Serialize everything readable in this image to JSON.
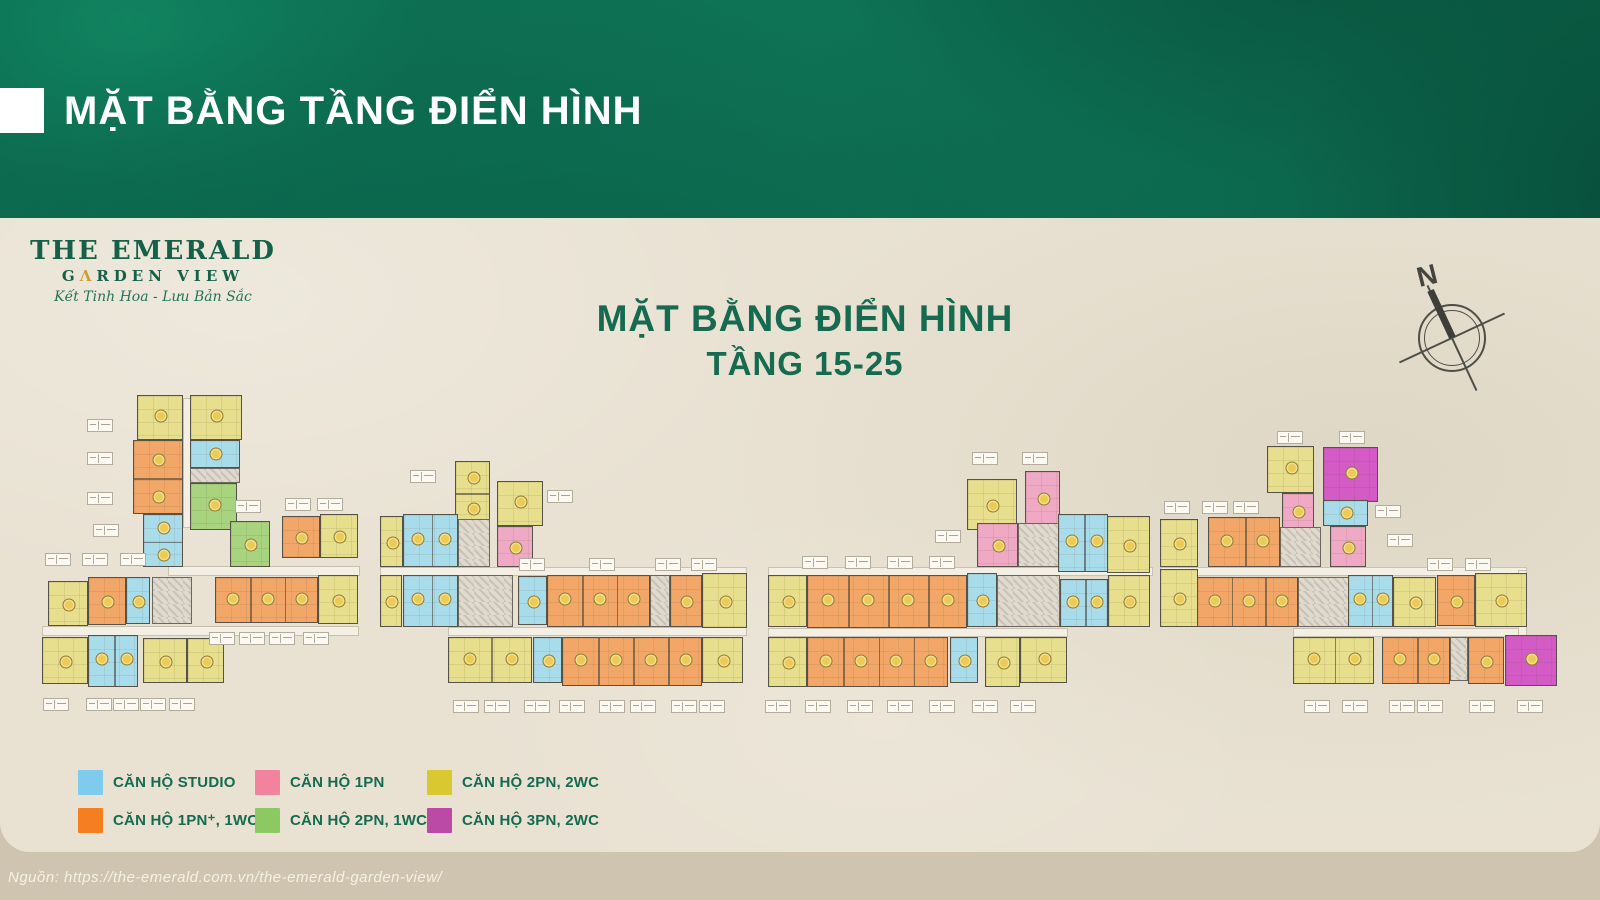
{
  "header": {
    "title": "MẶT BẰNG TẦNG ĐIỂN HÌNH",
    "band_color": "#0C6A4E",
    "accent_square_color": "#FFFFFF"
  },
  "logo": {
    "line1": "THE EMERALD",
    "line2": {
      "pre": "G",
      "accent": "Λ",
      "post": "RDEN VIEW"
    },
    "tagline": "Kết Tinh Hoa - Lưu Bản Sắc",
    "green": "#156049",
    "gold": "#C9A02E"
  },
  "plan_title": {
    "line1": "MẶT BẰNG ĐIỂN HÌNH",
    "line2": "TẦNG 15-25",
    "color": "#156A4F"
  },
  "compass": {
    "label": "N"
  },
  "legend": {
    "text_color": "#156A50",
    "items": [
      {
        "label": "CĂN HỘ STUDIO",
        "type": "studio"
      },
      {
        "label": "CĂN HỘ 1PN",
        "type": "1pn"
      },
      {
        "label": "CĂN HỘ 2PN, 2WC",
        "type": "2pn2wc"
      },
      {
        "label": "CĂN HỘ 1PN⁺, 1WC",
        "type": "1pnplus"
      },
      {
        "label": "CĂN HỘ 2PN, 1WC",
        "type": "2pn1wc"
      },
      {
        "label": "CĂN HỘ 3PN, 2WC",
        "type": "3pn2wc"
      }
    ]
  },
  "palette": {
    "legend": {
      "studio": "#7FCBEE",
      "1pn": "#F2839F",
      "2pn2wc": "#D8C930",
      "1pnplus": "#F57E21",
      "2pn1wc": "#8DC963",
      "3pn2wc": "#BA4AA5"
    },
    "plan": {
      "studio": "#A9DCEA",
      "1pn": "#EFA9C4",
      "2pn2wc": "#E7DF8D",
      "1pnplus": "#F2A768",
      "2pn1wc": "#A9D47F",
      "3pn2wc": "#D45BC5",
      "core": "#DFDACD"
    },
    "wall": "#55524A",
    "badge_fill": "#ECCB55",
    "badge_border": "#8F7D2F",
    "corridor": "#F3EFE5"
  },
  "source": {
    "text": "Nguồn: https://the-emerald.com.vn/the-emerald-garden-view/"
  },
  "plan": {
    "blocks": [
      [
        137,
        395,
        46,
        45,
        "2pn2wc"
      ],
      [
        190,
        395,
        52,
        45,
        "2pn2wc"
      ],
      [
        133,
        440,
        50,
        74,
        "1pnplus",
        2,
        "v"
      ],
      [
        190,
        440,
        50,
        28,
        "studio"
      ],
      [
        190,
        468,
        50,
        15,
        "core"
      ],
      [
        190,
        483,
        47,
        47,
        "2pn1wc"
      ],
      [
        143,
        514,
        40,
        53,
        "studio",
        2,
        "v"
      ],
      [
        230,
        521,
        40,
        46,
        "2pn1wc"
      ],
      [
        282,
        516,
        38,
        42,
        "1pnplus"
      ],
      [
        320,
        514,
        38,
        44,
        "2pn2wc"
      ],
      [
        48,
        581,
        40,
        45,
        "2pn2wc"
      ],
      [
        88,
        577,
        38,
        48,
        "1pnplus"
      ],
      [
        126,
        577,
        24,
        47,
        "studio"
      ],
      [
        152,
        577,
        40,
        47,
        "core"
      ],
      [
        215,
        577,
        103,
        46,
        "1pnplus",
        3,
        "h"
      ],
      [
        318,
        575,
        40,
        49,
        "2pn2wc"
      ],
      [
        42,
        637,
        46,
        47,
        "2pn2wc"
      ],
      [
        88,
        635,
        50,
        52,
        "studio",
        2,
        "h"
      ],
      [
        143,
        638,
        44,
        45,
        "2pn2wc"
      ],
      [
        187,
        638,
        37,
        45,
        "2pn2wc"
      ],
      [
        455,
        461,
        35,
        62,
        "2pn2wc",
        2,
        "v"
      ],
      [
        497,
        481,
        46,
        45,
        "2pn2wc"
      ],
      [
        497,
        526,
        36,
        41,
        "1pn"
      ],
      [
        380,
        516,
        23,
        51,
        "2pn2wc"
      ],
      [
        403,
        514,
        55,
        53,
        "studio",
        2,
        "h"
      ],
      [
        458,
        519,
        32,
        48,
        "core"
      ],
      [
        380,
        575,
        22,
        52,
        "2pn2wc"
      ],
      [
        403,
        575,
        55,
        52,
        "studio",
        2,
        "h"
      ],
      [
        458,
        575,
        55,
        52,
        "core"
      ],
      [
        518,
        576,
        29,
        49,
        "studio"
      ],
      [
        547,
        575,
        103,
        52,
        "1pnplus",
        3,
        "h"
      ],
      [
        650,
        575,
        20,
        52,
        "core"
      ],
      [
        670,
        575,
        32,
        52,
        "1pnplus"
      ],
      [
        702,
        573,
        45,
        55,
        "2pn2wc"
      ],
      [
        448,
        637,
        84,
        46,
        "2pn2wc",
        2,
        "h"
      ],
      [
        533,
        637,
        29,
        46,
        "studio"
      ],
      [
        562,
        637,
        140,
        49,
        "1pnplus",
        4,
        "h"
      ],
      [
        702,
        637,
        41,
        46,
        "2pn2wc"
      ],
      [
        967,
        479,
        50,
        51,
        "2pn2wc"
      ],
      [
        1025,
        471,
        35,
        54,
        "1pn"
      ],
      [
        977,
        523,
        41,
        44,
        "1pn"
      ],
      [
        1018,
        523,
        42,
        44,
        "core"
      ],
      [
        1058,
        514,
        50,
        58,
        "studio",
        2,
        "h"
      ],
      [
        1107,
        516,
        43,
        57,
        "2pn2wc"
      ],
      [
        768,
        575,
        39,
        52,
        "2pn2wc"
      ],
      [
        807,
        575,
        160,
        53,
        "1pnplus",
        4,
        "h"
      ],
      [
        967,
        573,
        30,
        54,
        "studio"
      ],
      [
        997,
        575,
        63,
        52,
        "core"
      ],
      [
        1060,
        579,
        48,
        48,
        "studio",
        2,
        "h"
      ],
      [
        1108,
        575,
        42,
        52,
        "2pn2wc"
      ],
      [
        768,
        637,
        39,
        50,
        "2pn2wc"
      ],
      [
        807,
        637,
        141,
        50,
        "1pnplus",
        4,
        "h"
      ],
      [
        950,
        637,
        28,
        46,
        "studio"
      ],
      [
        985,
        637,
        35,
        50,
        "2pn2wc"
      ],
      [
        1020,
        637,
        47,
        46,
        "2pn2wc"
      ],
      [
        1267,
        446,
        47,
        47,
        "2pn2wc"
      ],
      [
        1323,
        447,
        55,
        55,
        "3pn2wc"
      ],
      [
        1282,
        493,
        32,
        35,
        "1pn"
      ],
      [
        1323,
        500,
        45,
        26,
        "studio"
      ],
      [
        1330,
        526,
        36,
        41,
        "1pn"
      ],
      [
        1160,
        519,
        38,
        48,
        "2pn2wc"
      ],
      [
        1208,
        517,
        72,
        50,
        "1pnplus",
        2,
        "h"
      ],
      [
        1280,
        527,
        41,
        40,
        "core"
      ],
      [
        1160,
        569,
        38,
        58,
        "2pn2wc"
      ],
      [
        1197,
        577,
        101,
        50,
        "1pnplus",
        3,
        "h"
      ],
      [
        1298,
        577,
        51,
        50,
        "core"
      ],
      [
        1348,
        575,
        45,
        52,
        "studio",
        2,
        "h"
      ],
      [
        1393,
        577,
        43,
        50,
        "2pn2wc"
      ],
      [
        1437,
        575,
        38,
        51,
        "1pnplus"
      ],
      [
        1475,
        573,
        52,
        54,
        "2pn2wc"
      ],
      [
        1293,
        637,
        81,
        47,
        "2pn2wc",
        2,
        "h"
      ],
      [
        1382,
        637,
        68,
        47,
        "1pnplus",
        2,
        "h"
      ],
      [
        1450,
        637,
        18,
        44,
        "core"
      ],
      [
        1468,
        637,
        36,
        47,
        "1pnplus"
      ],
      [
        1505,
        635,
        52,
        51,
        "3pn2wc"
      ]
    ],
    "corridors": [
      [
        183,
        398,
        8,
        130
      ],
      [
        168,
        566,
        192,
        10
      ],
      [
        42,
        626,
        317,
        10
      ],
      [
        380,
        567,
        367,
        9
      ],
      [
        448,
        627,
        299,
        9
      ],
      [
        768,
        567,
        385,
        9
      ],
      [
        768,
        628,
        300,
        9
      ],
      [
        1160,
        567,
        367,
        9
      ],
      [
        1293,
        628,
        234,
        9
      ],
      [
        1518,
        570,
        9,
        66
      ]
    ],
    "tags": [
      [
        100,
        419
      ],
      [
        100,
        452
      ],
      [
        100,
        492
      ],
      [
        106,
        524
      ],
      [
        58,
        553
      ],
      [
        95,
        553
      ],
      [
        133,
        553
      ],
      [
        248,
        500
      ],
      [
        298,
        498
      ],
      [
        330,
        498
      ],
      [
        56,
        698
      ],
      [
        99,
        698
      ],
      [
        126,
        698
      ],
      [
        153,
        698
      ],
      [
        182,
        698
      ],
      [
        222,
        632
      ],
      [
        252,
        632
      ],
      [
        282,
        632
      ],
      [
        316,
        632
      ],
      [
        423,
        470
      ],
      [
        560,
        490
      ],
      [
        532,
        558
      ],
      [
        602,
        558
      ],
      [
        668,
        558
      ],
      [
        704,
        558
      ],
      [
        466,
        700
      ],
      [
        497,
        700
      ],
      [
        537,
        700
      ],
      [
        572,
        700
      ],
      [
        612,
        700
      ],
      [
        643,
        700
      ],
      [
        684,
        700
      ],
      [
        712,
        700
      ],
      [
        985,
        452
      ],
      [
        1035,
        452
      ],
      [
        948,
        530
      ],
      [
        815,
        556
      ],
      [
        858,
        556
      ],
      [
        900,
        556
      ],
      [
        942,
        556
      ],
      [
        778,
        700
      ],
      [
        818,
        700
      ],
      [
        860,
        700
      ],
      [
        900,
        700
      ],
      [
        942,
        700
      ],
      [
        985,
        700
      ],
      [
        1023,
        700
      ],
      [
        1290,
        431
      ],
      [
        1352,
        431
      ],
      [
        1177,
        501
      ],
      [
        1215,
        501
      ],
      [
        1246,
        501
      ],
      [
        1388,
        505
      ],
      [
        1400,
        534
      ],
      [
        1440,
        558
      ],
      [
        1478,
        558
      ],
      [
        1317,
        700
      ],
      [
        1355,
        700
      ],
      [
        1402,
        700
      ],
      [
        1430,
        700
      ],
      [
        1482,
        700
      ],
      [
        1530,
        700
      ]
    ]
  }
}
